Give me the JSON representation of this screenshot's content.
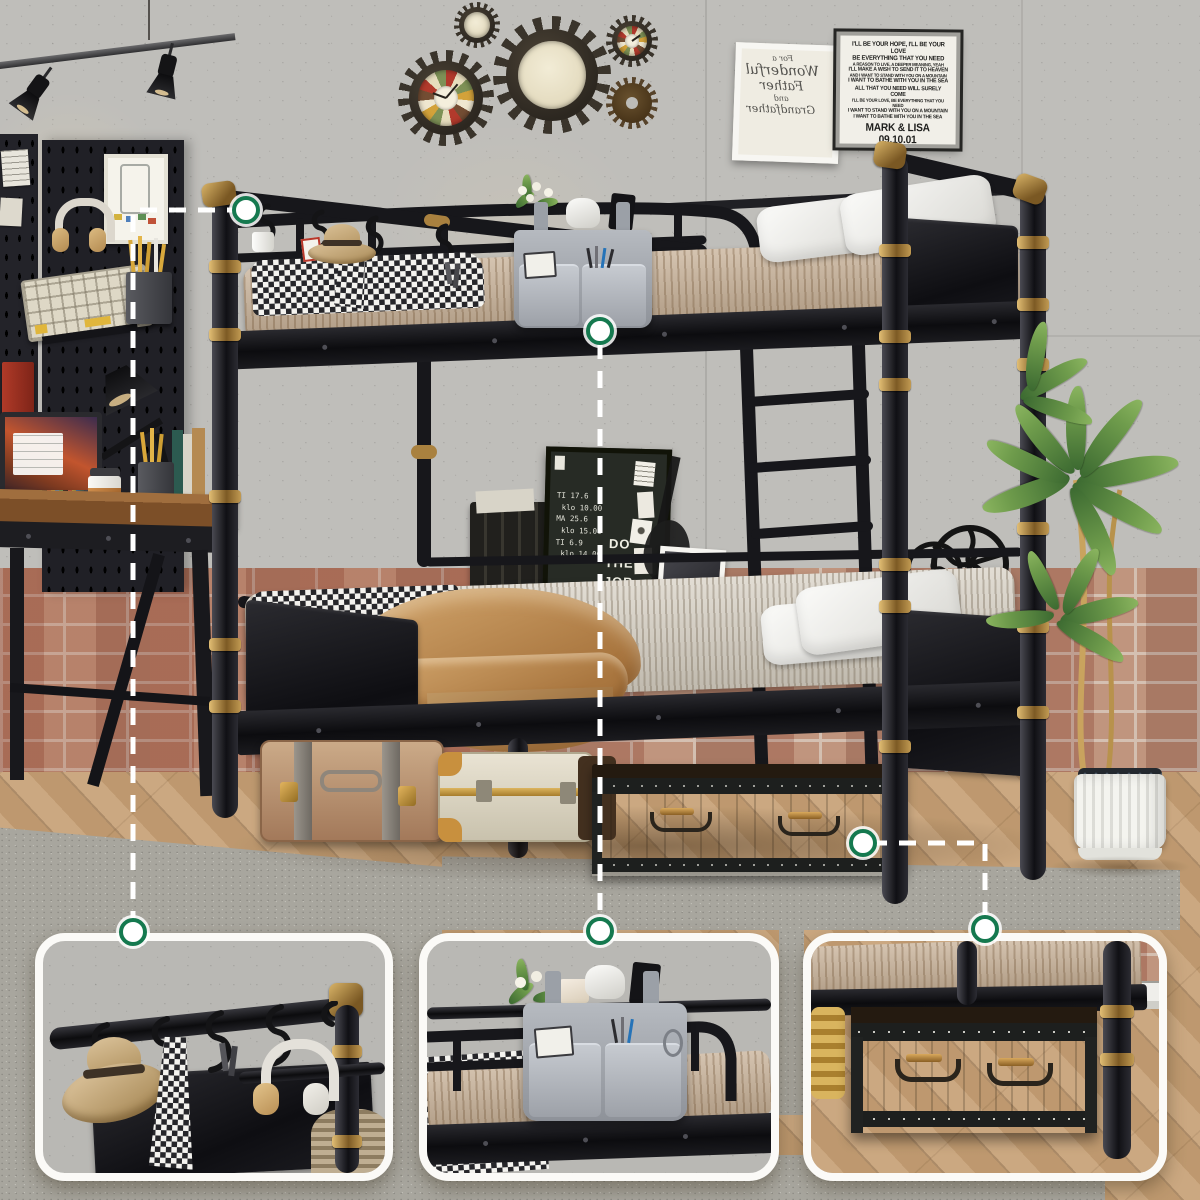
{
  "wall_decor": {
    "lyrics_plaque": {
      "lines": [
        "I'LL BE YOUR HOPE, I'LL BE YOUR LOVE",
        "BE EVERYTHING THAT YOU NEED",
        "A REASON TO LIVE, A DEEPER MEANING, YEAH",
        "I'LL MAKE A WISH TO SEND IT TO HEAVEN",
        "AND I WANT TO STAND WITH YOU ON A MOUNTAIN",
        "I WANT TO BATHE WITH YOU IN THE SEA",
        "ALL THAT YOU NEED WILL SURELY COME",
        "I'LL BE YOUR LOVE, BE EVERYTHING THAT YOU NEED",
        "I WANT TO STAND WITH YOU ON A MOUNTAIN",
        "I WANT TO BATHE WITH YOU IN THE SEA"
      ],
      "caption": "MARK & LISA 09.10.01"
    },
    "script_frame": {
      "mirrored": true,
      "lines": [
        "For a",
        "Wonderful",
        "Father",
        "and",
        "Grandfather"
      ]
    },
    "chalkboard": {
      "schedule": [
        "TI 17.6",
        "klo 10.00",
        "MA 25.6",
        "klo 15.00",
        "TI 6.9",
        "klo 14.00"
      ],
      "slogan_lines": [
        "DO",
        "THE",
        "JOB"
      ]
    }
  },
  "callouts": {
    "features": [
      {
        "id": "hanging-hook-rail"
      },
      {
        "id": "guardrail-storage-caddy"
      },
      {
        "id": "under-bed-storage-drawer"
      }
    ],
    "marker_color": "#15794f",
    "line_color": "#ffffff"
  },
  "colors": {
    "bed_black": "#1a1a1e",
    "brass": "#b08d4a",
    "concrete": "#bfbeba",
    "brick": "#bb907b",
    "floor_wood": "#c7a176",
    "rug": "#a8a69e",
    "caddy_gray": "#a7abb1",
    "blanket_camel": "#bf8f5c"
  }
}
